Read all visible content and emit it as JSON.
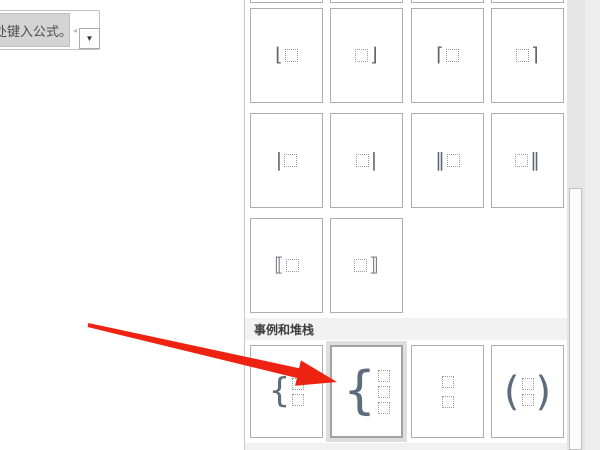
{
  "equation_control": {
    "placeholder_text": "在此处键入公式。",
    "dropdown_icon": "▼",
    "edge_marker_icon": "◂"
  },
  "panel": {
    "section_header": "事例和堆栈",
    "rows": {
      "single_brackets_1": [
        {
          "name": "left-floor-bracket",
          "left": "⌊",
          "right": ""
        },
        {
          "name": "right-floor-bracket",
          "left": "",
          "right": "⌋"
        },
        {
          "name": "left-ceiling-bracket",
          "left": "⌈",
          "right": ""
        },
        {
          "name": "right-ceiling-bracket",
          "left": "",
          "right": "⌉"
        }
      ],
      "single_brackets_2": [
        {
          "name": "left-vertical-bar",
          "left": "|",
          "right": ""
        },
        {
          "name": "right-vertical-bar",
          "left": "",
          "right": "|"
        },
        {
          "name": "left-double-vertical-bar",
          "left": "‖",
          "right": ""
        },
        {
          "name": "right-double-vertical-bar",
          "left": "",
          "right": "‖"
        }
      ],
      "single_brackets_3": [
        {
          "name": "left-white-square-bracket",
          "left": "⟦",
          "right": ""
        },
        {
          "name": "right-white-square-bracket",
          "left": "",
          "right": "⟧"
        }
      ],
      "cases_and_stacks": [
        {
          "name": "cases-two-conditions",
          "left": "{",
          "right": "",
          "boxes": 2
        },
        {
          "name": "cases-three-conditions",
          "left": "{",
          "right": "",
          "boxes": 3,
          "highlighted": true
        },
        {
          "name": "stack-object",
          "left": "",
          "right": "",
          "boxes": 2
        },
        {
          "name": "binomial-coefficient",
          "left": "(",
          "right": ")",
          "boxes": 2
        }
      ]
    }
  },
  "annotation": {
    "arrow_color": "#ee2211",
    "arrow_points": "88.4,323 299.1,368.2 300.9,360.4 337,382 295.1,385.8 296.9,378 87.6,327"
  },
  "colors": {
    "cell_border": "#aeaeae",
    "section_header_bg": "#f2f2f2",
    "scroll_track": "#e5e5e5",
    "placeholder_fill": "#d4d4d4"
  }
}
